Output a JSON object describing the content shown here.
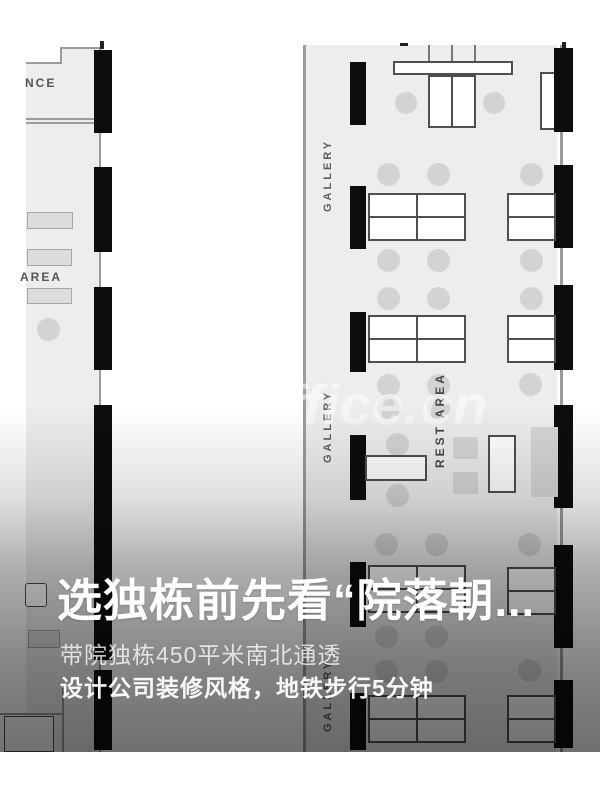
{
  "floorplan": {
    "labels": {
      "entrance_partial": "NCE",
      "area_partial": "AREA",
      "gallery": "GALLERY",
      "rest_area": "REST AREA"
    },
    "watermark": "ffice.cn",
    "colors": {
      "floor": "#ededed",
      "wall": "#9b9b9b",
      "column": "#0d0d0d",
      "furniture_fill": "#ffffff",
      "chair_fill": "#d3d3d3"
    }
  },
  "caption": {
    "title": "选独栋前先看“院落朝...",
    "subtitle1": "带院独栋450平米南北通透",
    "subtitle2": "设计公司装修风格，地铁步行5分钟"
  }
}
